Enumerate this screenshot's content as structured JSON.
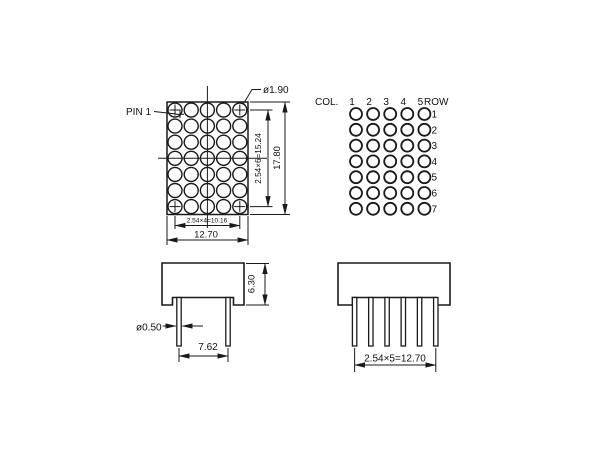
{
  "drawing": {
    "front_view": {
      "pin1_label": "PIN 1",
      "dot_diameter": "ø1.90",
      "dot_col_pitch": "2.54×4=10.16",
      "overall_width": "12.70",
      "dot_row_pitch": "2.54×6=15.24",
      "overall_height": "17.80",
      "rows": 7,
      "cols": 5
    },
    "pattern_view": {
      "col_header": "COL.",
      "row_header": "ROW",
      "col_labels": [
        "1",
        "2",
        "3",
        "4",
        "5"
      ],
      "row_labels": [
        "1",
        "2",
        "3",
        "4",
        "5",
        "6",
        "7"
      ]
    },
    "side_view": {
      "body_height": "6.30",
      "pin_diameter": "ø0.50",
      "pin_pitch": "7.62",
      "pins": 2
    },
    "front_pin_view": {
      "pin_span": "2.54×5=12.70",
      "pins": 6
    },
    "colors": {
      "line": "#1a1a1a",
      "background": "#ffffff"
    }
  }
}
